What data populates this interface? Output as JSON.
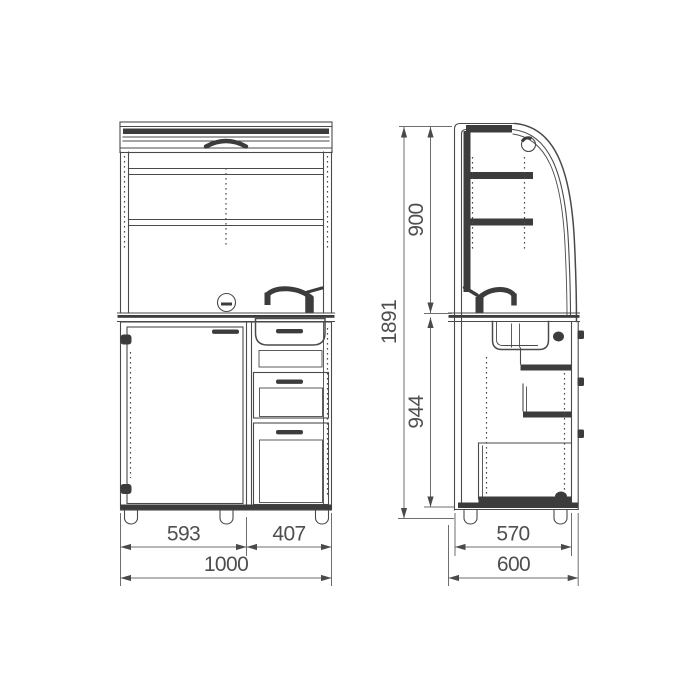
{
  "drawing": {
    "front_view": {
      "dim_door_width": "593",
      "dim_drawer_width": "407",
      "dim_total_width": "1000"
    },
    "side_view": {
      "dim_upper_height": "900",
      "dim_lower_height": "944",
      "dim_total_height": "1891",
      "dim_body_depth": "570",
      "dim_total_depth": "600"
    },
    "colors": {
      "line": "#4a4a4a",
      "dark_fill": "#3c3c3c",
      "dim_line": "#6e6e6e",
      "text": "#4f4f4f",
      "background": "#ffffff"
    }
  }
}
